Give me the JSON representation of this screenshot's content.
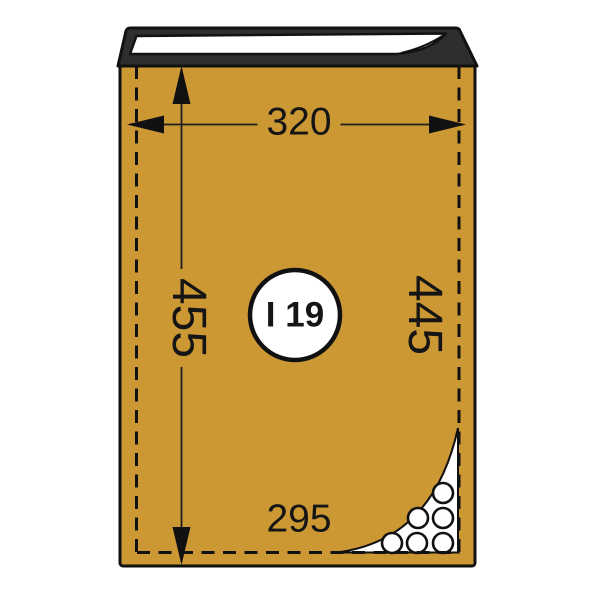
{
  "labels": {
    "width_top": "320",
    "height_left": "455",
    "height_right": "445",
    "width_bottom": "295",
    "badge": "I 19"
  },
  "icons": {
    "arrows": [
      "arrowhead-left",
      "arrowhead-right",
      "arrowhead-up",
      "arrowhead-down"
    ],
    "bubble_count": 6
  },
  "colors": {
    "envelope": "#cc9834",
    "flap": "#2e2e2e",
    "liner": "#ffffff",
    "outline": "#111111",
    "dimension_text": "#151515"
  }
}
